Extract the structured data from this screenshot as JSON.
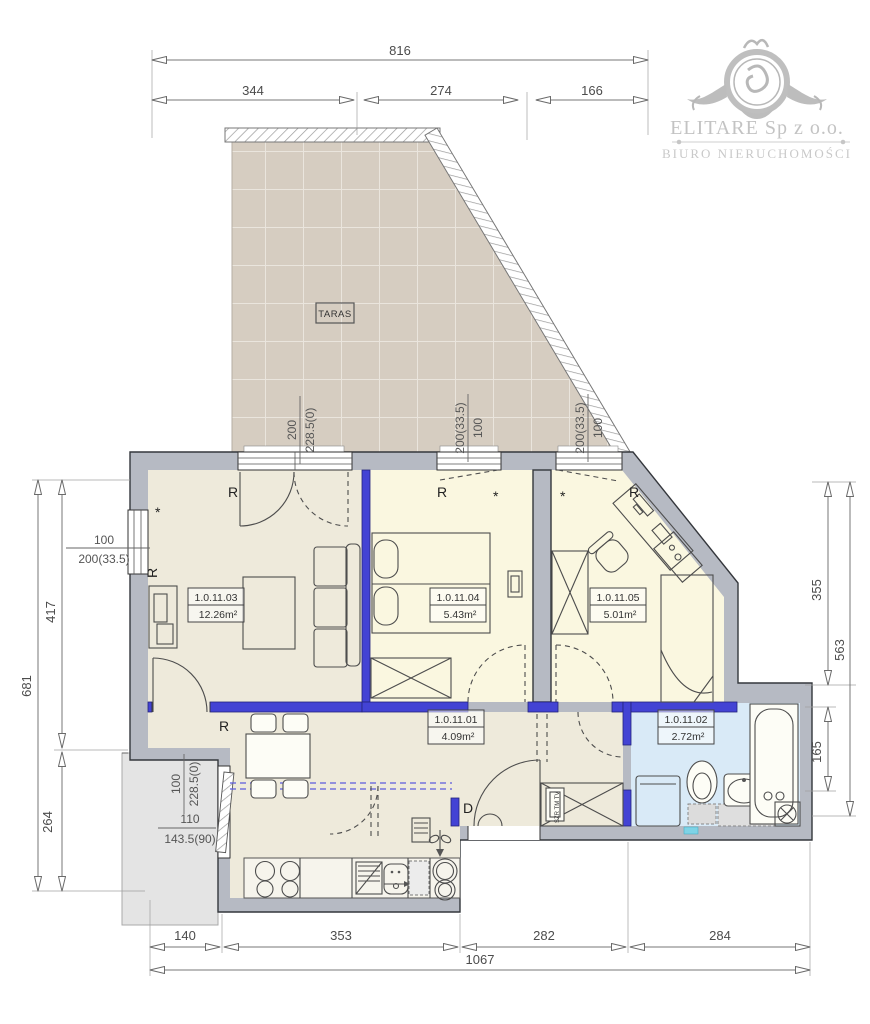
{
  "logo": {
    "company": "ELITARE Sp z o.o.",
    "subtitle": "BIURO NIERUCHOMOŚCI"
  },
  "terrace": {
    "label": "TARAS"
  },
  "rooms": [
    {
      "id": "1.0.11.03",
      "area": "12.26m²"
    },
    {
      "id": "1.0.11.04",
      "area": "5.43m²"
    },
    {
      "id": "1.0.11.05",
      "area": "5.01m²"
    },
    {
      "id": "1.0.11.01",
      "area": "4.09m²"
    },
    {
      "id": "1.0.11.02",
      "area": "2.72m²"
    }
  ],
  "dims": {
    "top": [
      "816",
      "344",
      "274",
      "166"
    ],
    "bottom": [
      "140",
      "353",
      "282",
      "284",
      "1067"
    ],
    "left": [
      "681",
      "417",
      "264"
    ],
    "right": [
      "355",
      "563",
      "165"
    ]
  },
  "openings": {
    "left_window": {
      "top": "100",
      "bottom": "200(33.5)"
    },
    "balcony_door": {
      "num": "200",
      "den": "228.5(0)"
    },
    "window_2": {
      "num": "200(33.5)",
      "den": "100"
    },
    "window_3": {
      "num": "200(33.5)",
      "den": "100"
    },
    "lower_left_window": {
      "num": "100",
      "den": "228.5(0)"
    },
    "lower_left_door": {
      "top": "110",
      "bottom": "143.5(90)"
    }
  },
  "marks": {
    "r": "R",
    "star": "*",
    "entrance": "D",
    "closet": "SZR TM TV"
  },
  "colors": {
    "wall": "#b6bac3",
    "partition": "#4343d4",
    "living_floor": "#eeeadb",
    "bedroom_floor": "#faf7e0",
    "bath_floor": "#d9eaf7",
    "terrace": "#d6cdc1",
    "outdoor": "#e4e4e4",
    "cyan_marker": "#7ed3e6"
  }
}
